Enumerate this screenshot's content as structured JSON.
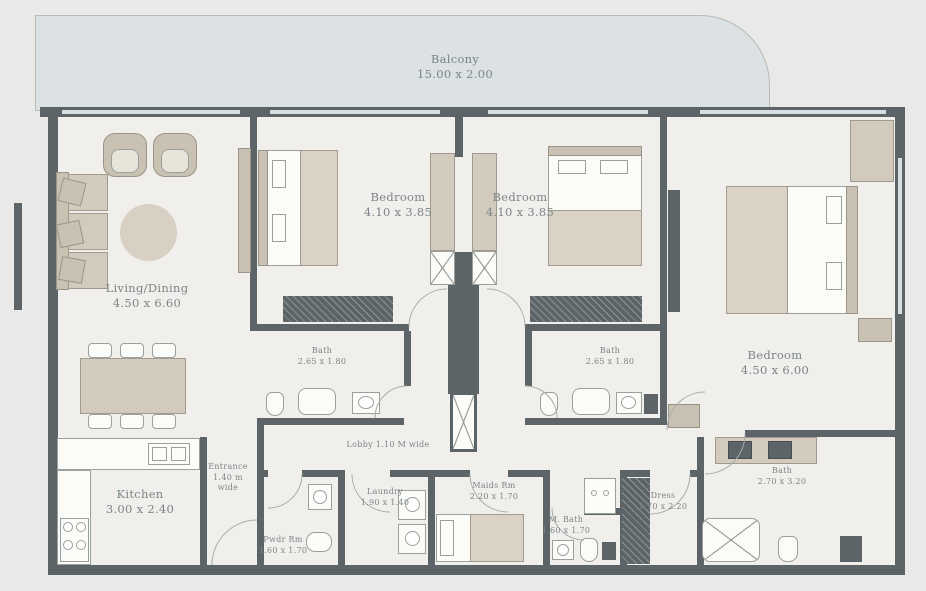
{
  "plan_type": "apartment-floor-plan",
  "colors": {
    "wall": "#5d6467",
    "balcony_fill": "#dce1e4",
    "floor": "#f0efeb",
    "furniture_beige": "#d2cbbd",
    "label_text": "#7b8589"
  },
  "balcony": {
    "name": "Balcony",
    "dims": "15.00 x 2.00"
  },
  "rooms": {
    "living": {
      "name": "Living/Dining",
      "dims": "4.50 x 6.60"
    },
    "bedroom1": {
      "name": "Bedroom",
      "dims": "4.10 x 3.85"
    },
    "bedroom2": {
      "name": "Bedroom",
      "dims": "4.10 x 3.85"
    },
    "bedroom3": {
      "name": "Bedroom",
      "dims": "4.50 x 6.00"
    },
    "bath1": {
      "name": "Bath",
      "dims": "2.65 x 1.80"
    },
    "bath2": {
      "name": "Bath",
      "dims": "2.65 x 1.80"
    },
    "bath3": {
      "name": "Bath",
      "dims": "2.70 x 3.20"
    },
    "kitchen": {
      "name": "Kitchen",
      "dims": "3.00 x 2.40"
    },
    "entrance": {
      "name": "Entrance",
      "line2": "1.40 m",
      "line3": "wide"
    },
    "lobby": {
      "name": "Lobby 1.10 M wide"
    },
    "laundry": {
      "name": "Laundry",
      "dims": "1.90 x 1.40"
    },
    "powder": {
      "name": "Pwdr Rm",
      "dims": "1.60 x 1.70"
    },
    "maids": {
      "name": "Maids Rm",
      "dims": "2.20 x 1.70"
    },
    "maids_bath": {
      "name": "M. Bath",
      "dims": "1.60 x 1.70"
    },
    "dress": {
      "name": "Dress",
      "dims": "1.70 x 2.20"
    }
  }
}
